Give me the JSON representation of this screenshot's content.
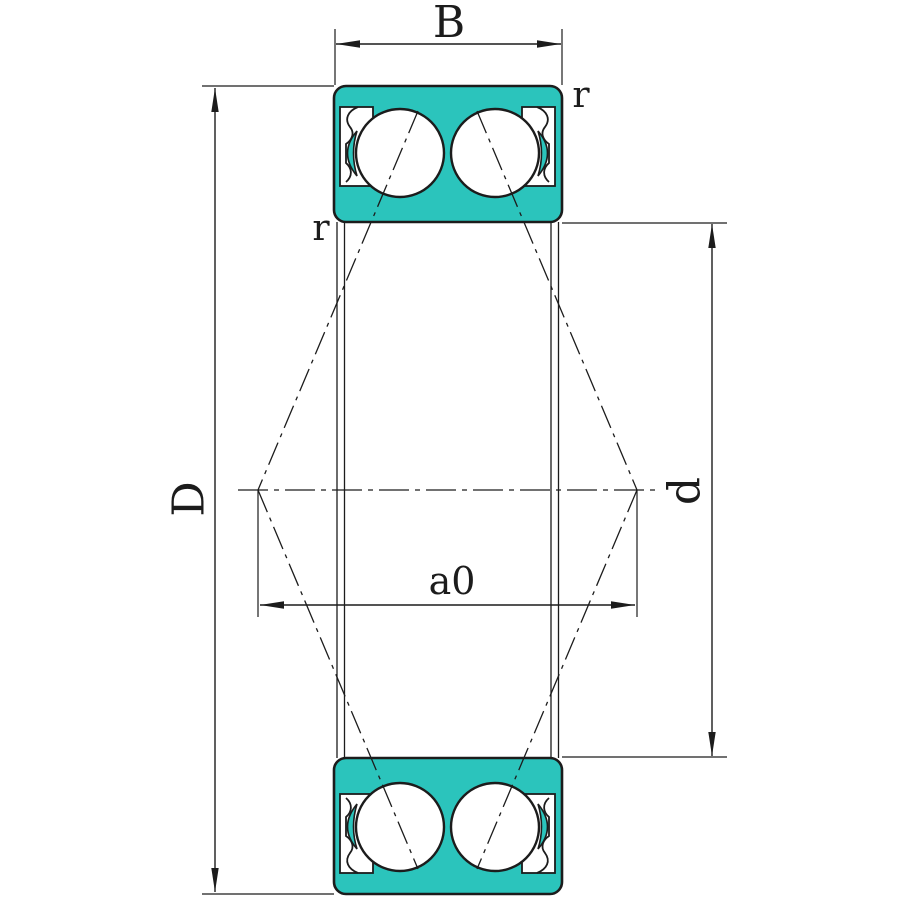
{
  "drawing": {
    "background": "#ffffff",
    "stroke": "#1c1c1c",
    "ring_fill": "#2bc4bc",
    "ball_fill": "#ffffff",
    "pocket_fill": "#ffffff"
  },
  "dimensions": {
    "width_label": "B",
    "outer_diameter_label": "D",
    "bore_diameter_label": "d",
    "load_center_distance_label": "a0",
    "outer_ring_chamfer_label": "r",
    "inner_ring_chamfer_label": "r"
  }
}
